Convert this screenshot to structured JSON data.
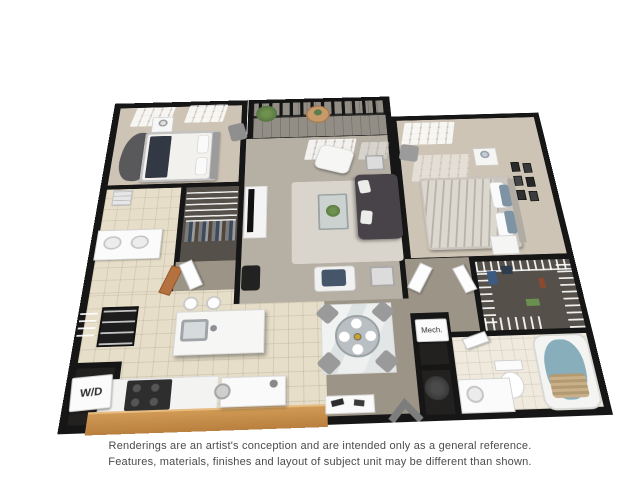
{
  "image_type": "3d-floor-plan-rendering",
  "plan": {
    "labels": {
      "washer_dryer": "W/D",
      "mechanical": "Mech."
    },
    "rooms": [
      "bedroom-1",
      "bathroom-1",
      "closet-1",
      "kitchen",
      "laundry-closet",
      "living-room",
      "dining-area",
      "balcony",
      "bedroom-2",
      "hallway",
      "walk-in-closet",
      "bathroom-2",
      "mechanical-closet",
      "utility-nook"
    ],
    "icons": {
      "watermark": "chevron-up-icon"
    },
    "colors": {
      "wall": "#161616",
      "bedroom_floor": "#cec4b5",
      "living_carpet": "#b6afa4",
      "dining_floor": "#9d9488",
      "kitchen_tile": "#e6dec9",
      "bath_tile": "#efeadd",
      "closet_floor": "#55504a",
      "wood_counter": "#c98f4e",
      "sofa": "#474349",
      "tub_water": "#88aebc",
      "plant": "#5d7d4a"
    }
  },
  "disclaimer": {
    "line1": "Renderings are an artist's conception and are intended only as a general reference.",
    "line2": "Features, materials, finishes and layout of subject unit may be different than shown."
  }
}
